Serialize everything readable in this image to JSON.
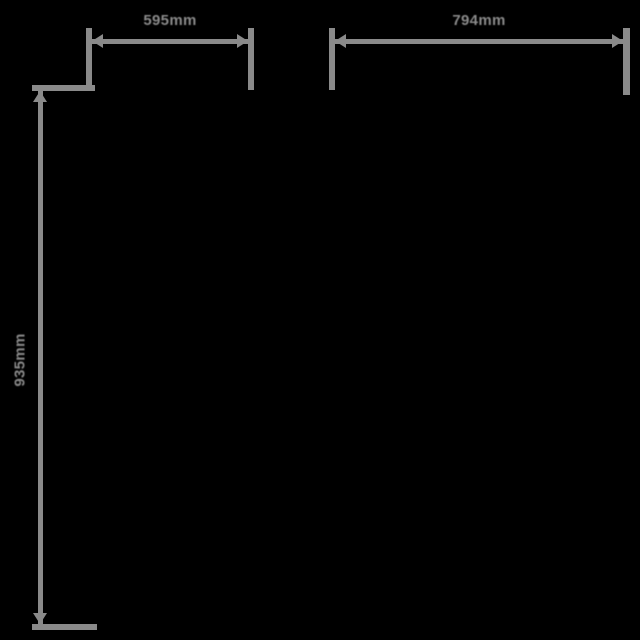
{
  "diagram": {
    "type": "product-dimension-drawing",
    "unit": "mm",
    "theme": {
      "background": "#000000",
      "line": "#8a8a8a",
      "text": "#8a8a8a"
    },
    "dimensions": [
      {
        "name": "width-left",
        "label": "595mm",
        "orientation": "horizontal"
      },
      {
        "name": "width-right",
        "label": "794mm",
        "orientation": "horizontal"
      },
      {
        "name": "height-left",
        "label": "935mm",
        "orientation": "vertical"
      }
    ]
  }
}
